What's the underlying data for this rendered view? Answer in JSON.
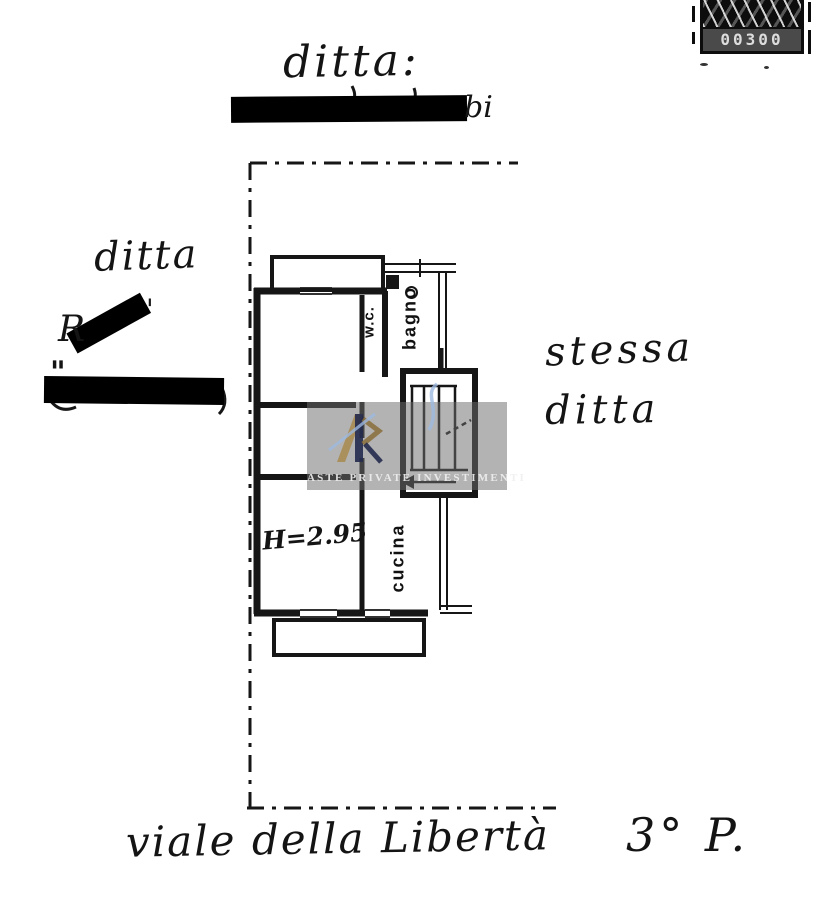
{
  "colors": {
    "paper": "#ffffff",
    "ink": "#161616",
    "watermark_band": "#6e6e6e",
    "logo_gold": "#a8894e",
    "logo_navy": "#232a4d",
    "logo_blue": "#9db9e0"
  },
  "stamp": {
    "value": "00300"
  },
  "header": {
    "ditta_label": "ditta:",
    "redacted_suffix": "bi"
  },
  "left_notes": {
    "ditta_label": "ditta",
    "leak_prefix": "R",
    "apostrophe": "'",
    "quote_mark": "\""
  },
  "right_notes": {
    "line1": "stessa",
    "line2": "ditta"
  },
  "plan": {
    "room_labels": {
      "wc": "w.c.",
      "bagno": "bagno",
      "cucina": "cucina"
    },
    "height_note": "H=2.95"
  },
  "watermark": {
    "text": "ASTE PRIVATE INVESTIMENTI"
  },
  "footer": {
    "street_name": "viale della Libertà",
    "floor_note": "3° P."
  }
}
